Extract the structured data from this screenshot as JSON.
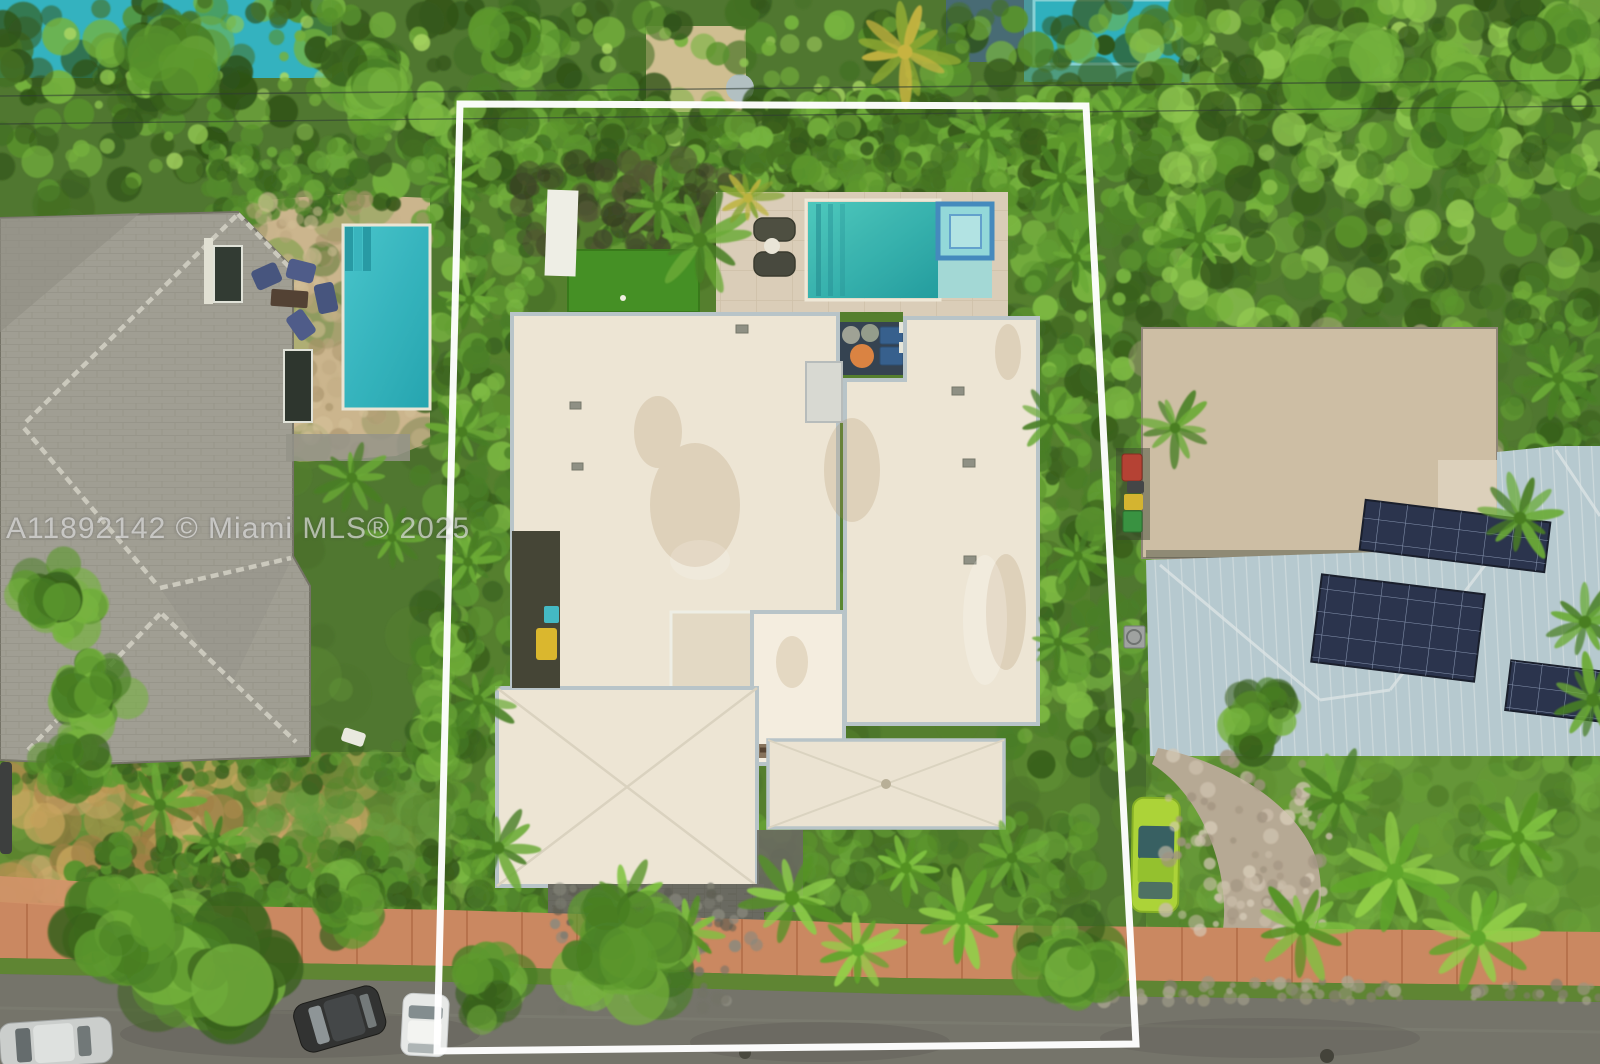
{
  "watermark": {
    "text": "A11892142 © Miami MLS® 2025",
    "color": "#eaeaea"
  },
  "palette": {
    "veg_base": "#47722c",
    "gray_roof": "#9b9b94",
    "ridge": "#c9c9c0",
    "roof": "#ece6d9",
    "parapet": "#b5c3cc",
    "deck": "#d8cdbb",
    "turf": "#3c8d20",
    "rug": "#2b3c4e",
    "pouf": "#d97f3f",
    "tanroof": "#cbbda6",
    "metal": "#b3c9d3",
    "solar": "#202c4a",
    "street": "#6e6f69",
    "sidewalk": "#c8845f",
    "paver": "#63655f",
    "lime": "#a8d334",
    "pool_center": "#2ab5b5",
    "pool_left": "#2fb9c6",
    "outline": "#ffffff"
  },
  "scene": {
    "mottle": [
      {
        "layer": "a",
        "x": 0,
        "y": 200,
        "w": 1600,
        "h": 864,
        "n": 420,
        "rmin": 10,
        "rmax": 30,
        "colors": [
          "#3f6a24",
          "#4e8029",
          "#5f9634",
          "#365c1e"
        ],
        "omin": 0.2,
        "omax": 0.5,
        "seed": 11
      },
      {
        "layer": "a",
        "x": 0,
        "y": 0,
        "w": 1600,
        "h": 205,
        "n": 520,
        "rmin": 7,
        "rmax": 20,
        "colors": [
          "#2c5317",
          "#3a6b1e",
          "#4f8f28",
          "#6fb13a",
          "#244b12"
        ],
        "omin": 0.5,
        "omax": 0.95,
        "seed": 12
      },
      {
        "layer": "a",
        "x": 60,
        "y": 20,
        "w": 1500,
        "h": 150,
        "n": 140,
        "rmin": 4,
        "rmax": 10,
        "colors": [
          "#8cc84e",
          "#a4d65f",
          "#6fae38"
        ],
        "omin": 0.5,
        "omax": 0.9,
        "seed": 13
      },
      {
        "layer": "a",
        "x": 420,
        "y": 90,
        "w": 115,
        "h": 930,
        "n": 330,
        "rmin": 6,
        "rmax": 18,
        "colors": [
          "#2f5a19",
          "#417a22",
          "#58992e",
          "#76b83f"
        ],
        "omin": 0.5,
        "omax": 0.95,
        "seed": 14
      },
      {
        "layer": "a",
        "x": 1005,
        "y": 95,
        "w": 155,
        "h": 670,
        "n": 300,
        "rmin": 6,
        "rmax": 18,
        "colors": [
          "#2f5a19",
          "#417a22",
          "#58992e",
          "#76b83f"
        ],
        "omin": 0.5,
        "omax": 0.95,
        "seed": 15
      },
      {
        "layer": "a",
        "x": 1140,
        "y": 0,
        "w": 460,
        "h": 335,
        "n": 400,
        "rmin": 7,
        "rmax": 20,
        "colors": [
          "#2c5317",
          "#3d701f",
          "#549428",
          "#72b23a",
          "#8cc84e"
        ],
        "omin": 0.5,
        "omax": 0.9,
        "seed": 16
      },
      {
        "layer": "a",
        "x": 1488,
        "y": 300,
        "w": 112,
        "h": 470,
        "n": 180,
        "rmin": 6,
        "rmax": 16,
        "colors": [
          "#2f5a19",
          "#447c24",
          "#5da031"
        ],
        "omin": 0.5,
        "omax": 0.9,
        "seed": 17
      },
      {
        "layer": "a",
        "x": 0,
        "y": 545,
        "w": 135,
        "h": 240,
        "n": 120,
        "rmin": 6,
        "rmax": 16,
        "colors": [
          "#31601a",
          "#447c24",
          "#5da031"
        ],
        "omin": 0.45,
        "omax": 0.85,
        "seed": 18
      },
      {
        "layer": "a",
        "x": 205,
        "y": 145,
        "w": 155,
        "h": 75,
        "n": 90,
        "rmin": 5,
        "rmax": 12,
        "colors": [
          "#31601a",
          "#4a8526",
          "#65a836"
        ],
        "omin": 0.5,
        "omax": 0.9,
        "seed": 19
      },
      {
        "layer": "a",
        "x": 458,
        "y": 100,
        "w": 630,
        "h": 105,
        "n": 430,
        "rmin": 6,
        "rmax": 16,
        "colors": [
          "#2c5317",
          "#3d701f",
          "#549428",
          "#6fb13a"
        ],
        "omin": 0.55,
        "omax": 0.95,
        "seed": 20
      },
      {
        "layer": "a",
        "x": 596,
        "y": 165,
        "w": 140,
        "h": 92,
        "n": 100,
        "rmin": 5,
        "rmax": 12,
        "colors": [
          "#2f5a19",
          "#4a8526",
          "#68a837"
        ],
        "omin": 0.5,
        "omax": 0.9,
        "seed": 21
      },
      {
        "layer": "a",
        "x": 520,
        "y": 160,
        "w": 220,
        "h": 90,
        "n": 90,
        "rmin": 6,
        "rmax": 14,
        "colors": [
          "#3a4526",
          "#2e3a1e",
          "#4a5230"
        ],
        "omin": 0.5,
        "omax": 0.85,
        "seed": 35
      },
      {
        "layer": "a",
        "x": 1150,
        "y": 700,
        "w": 450,
        "h": 240,
        "n": 240,
        "rmin": 8,
        "rmax": 22,
        "colors": [
          "#4e8029",
          "#5f9a31",
          "#3f7021",
          "#6fae3c"
        ],
        "omin": 0.3,
        "omax": 0.6,
        "seed": 22
      },
      {
        "layer": "a",
        "x": 0,
        "y": 755,
        "w": 450,
        "h": 150,
        "n": 170,
        "rmin": 8,
        "rmax": 20,
        "colors": [
          "#557f2e",
          "#6b9a3a",
          "#4b7427"
        ],
        "omin": 0.3,
        "omax": 0.6,
        "seed": 23
      },
      {
        "layer": "a",
        "x": 8,
        "y": 768,
        "w": 350,
        "h": 125,
        "n": 110,
        "rmin": 8,
        "rmax": 26,
        "colors": [
          "#b5914f",
          "#c7a55e",
          "#9b7a42",
          "#caa86b"
        ],
        "omin": 0.45,
        "omax": 0.8,
        "seed": 24
      },
      {
        "layer": "a",
        "x": 250,
        "y": 760,
        "w": 200,
        "h": 140,
        "n": 80,
        "rmin": 8,
        "rmax": 20,
        "colors": [
          "#4e8029",
          "#60993a"
        ],
        "omin": 0.4,
        "omax": 0.7,
        "seed": 25
      },
      {
        "layer": "a",
        "x": 75,
        "y": 843,
        "w": 375,
        "h": 68,
        "n": 190,
        "rmin": 6,
        "rmax": 14,
        "colors": [
          "#2c5317",
          "#3d701f",
          "#4f8f28"
        ],
        "omin": 0.55,
        "omax": 0.95,
        "seed": 26
      },
      {
        "layer": "a",
        "x": 0,
        "y": 745,
        "w": 440,
        "h": 42,
        "n": 120,
        "rmin": 5,
        "rmax": 11,
        "colors": [
          "#2f5a19",
          "#447c24",
          "#58992e"
        ],
        "omin": 0.5,
        "omax": 0.9,
        "seed": 27
      },
      {
        "layer": "a",
        "x": 458,
        "y": 818,
        "w": 640,
        "h": 100,
        "n": 230,
        "rmin": 7,
        "rmax": 16,
        "colors": [
          "#3f7021",
          "#549428",
          "#65a836",
          "#2f5a19"
        ],
        "omin": 0.4,
        "omax": 0.75,
        "seed": 28
      },
      {
        "layer": "a",
        "x": 248,
        "y": 198,
        "w": 180,
        "h": 255,
        "n": 140,
        "rmin": 4,
        "rmax": 11,
        "colors": [
          "#b9a47e",
          "#d2c09a",
          "#a5906a",
          "#c4b18b"
        ],
        "omin": 0.35,
        "omax": 0.65,
        "seed": 29
      },
      {
        "layer": "a",
        "x": 1146,
        "y": 332,
        "w": 347,
        "h": 222,
        "n": 150,
        "rmin": 6,
        "rmax": 20,
        "colors": [
          "#d7ccb8",
          "#bcae97",
          "#cdc0aa",
          "#b2a48c"
        ],
        "omin": 0.35,
        "omax": 0.65,
        "seed": 30
      },
      {
        "layer": "b",
        "x": 552,
        "y": 886,
        "w": 208,
        "h": 72,
        "n": 70,
        "rmin": 3,
        "rmax": 7,
        "colors": [
          "#75776f",
          "#54564f",
          "#83857d"
        ],
        "omin": 0.5,
        "omax": 0.85,
        "seed": 31
      },
      {
        "layer": "b",
        "x": 560,
        "y": 966,
        "w": 170,
        "h": 44,
        "n": 50,
        "rmin": 3,
        "rmax": 7,
        "colors": [
          "#8a8c84",
          "#6b6d65"
        ],
        "omin": 0.5,
        "omax": 0.8,
        "seed": 32
      },
      {
        "layer": "b",
        "x": 1165,
        "y": 752,
        "w": 165,
        "h": 180,
        "n": 90,
        "rmin": 3,
        "rmax": 8,
        "colors": [
          "#c7bcab",
          "#9c9080",
          "#d3c9b9"
        ],
        "omin": 0.5,
        "omax": 0.85,
        "seed": 33
      },
      {
        "layer": "b",
        "x": 1090,
        "y": 980,
        "w": 510,
        "h": 22,
        "n": 70,
        "rmin": 3,
        "rmax": 7,
        "colors": [
          "#96937f",
          "#7e7b6c",
          "#a7a492"
        ],
        "omin": 0.5,
        "omax": 0.8,
        "seed": 34
      }
    ],
    "palms": [
      {
        "x": 700,
        "y": 240,
        "r": 46,
        "seed": 101
      },
      {
        "x": 658,
        "y": 206,
        "r": 34,
        "seed": 102
      },
      {
        "x": 748,
        "y": 198,
        "r": 30,
        "seed": 103,
        "c": [
          "#b9b23a",
          "#7da02c"
        ]
      },
      {
        "x": 905,
        "y": 52,
        "r": 46,
        "seed": 104,
        "c": [
          "#c4b23e",
          "#86a42e"
        ]
      },
      {
        "x": 985,
        "y": 135,
        "r": 32,
        "seed": 105
      },
      {
        "x": 1118,
        "y": 115,
        "r": 36,
        "seed": 106
      },
      {
        "x": 452,
        "y": 182,
        "r": 28,
        "seed": 107
      },
      {
        "x": 470,
        "y": 300,
        "r": 30,
        "seed": 108
      },
      {
        "x": 462,
        "y": 432,
        "r": 34,
        "seed": 109
      },
      {
        "x": 468,
        "y": 562,
        "r": 30,
        "seed": 110
      },
      {
        "x": 478,
        "y": 700,
        "r": 34,
        "seed": 111
      },
      {
        "x": 498,
        "y": 848,
        "r": 40,
        "seed": 112
      },
      {
        "x": 1062,
        "y": 178,
        "r": 34,
        "seed": 113
      },
      {
        "x": 1076,
        "y": 258,
        "r": 30,
        "seed": 114
      },
      {
        "x": 1052,
        "y": 420,
        "r": 32,
        "seed": 115
      },
      {
        "x": 1078,
        "y": 556,
        "r": 30,
        "seed": 116
      },
      {
        "x": 1058,
        "y": 642,
        "r": 28,
        "seed": 117
      },
      {
        "x": 625,
        "y": 905,
        "r": 42,
        "seed": 118,
        "c": [
          "#4c8f1e",
          "#79c23c"
        ]
      },
      {
        "x": 688,
        "y": 932,
        "r": 34,
        "seed": 119,
        "c": [
          "#4c8f1e",
          "#79c23c"
        ]
      },
      {
        "x": 792,
        "y": 898,
        "r": 46,
        "seed": 120,
        "c": [
          "#4c8f1e",
          "#86cc45"
        ]
      },
      {
        "x": 858,
        "y": 950,
        "r": 40,
        "seed": 121,
        "c": [
          "#58a426",
          "#8ccf45"
        ]
      },
      {
        "x": 906,
        "y": 868,
        "r": 36,
        "seed": 122,
        "c": [
          "#4c8f1e",
          "#79c23c"
        ]
      },
      {
        "x": 962,
        "y": 918,
        "r": 44,
        "seed": 123,
        "c": [
          "#58a426",
          "#8ccf45"
        ]
      },
      {
        "x": 1012,
        "y": 858,
        "r": 34,
        "seed": 124
      },
      {
        "x": 1395,
        "y": 872,
        "r": 54,
        "seed": 125,
        "c": [
          "#58a426",
          "#8ccf45"
        ]
      },
      {
        "x": 1302,
        "y": 928,
        "r": 46,
        "seed": 126,
        "c": [
          "#4c8f1e",
          "#79c23c"
        ]
      },
      {
        "x": 1478,
        "y": 938,
        "r": 50,
        "seed": 127,
        "c": [
          "#58a426",
          "#8ccf45"
        ]
      },
      {
        "x": 1338,
        "y": 798,
        "r": 42,
        "seed": 128
      },
      {
        "x": 1518,
        "y": 838,
        "r": 42,
        "seed": 129,
        "c": [
          "#4c8f1e",
          "#79c23c"
        ]
      },
      {
        "x": 160,
        "y": 805,
        "r": 38,
        "seed": 130
      },
      {
        "x": 214,
        "y": 843,
        "r": 30,
        "seed": 131
      },
      {
        "x": 352,
        "y": 478,
        "r": 34,
        "seed": 132
      },
      {
        "x": 392,
        "y": 538,
        "r": 28,
        "seed": 133
      },
      {
        "x": 1200,
        "y": 238,
        "r": 38,
        "seed": 134
      },
      {
        "x": 1520,
        "y": 518,
        "r": 40,
        "seed": 135
      },
      {
        "x": 1558,
        "y": 378,
        "r": 36,
        "seed": 136
      },
      {
        "x": 1175,
        "y": 428,
        "r": 34,
        "seed": 137
      },
      {
        "x": 1585,
        "y": 622,
        "r": 40,
        "seed": 138
      },
      {
        "x": 1593,
        "y": 700,
        "r": 42,
        "seed": 139
      }
    ],
    "canopies": [
      {
        "x": 210,
        "y": 958,
        "r": 85
      },
      {
        "x": 118,
        "y": 934,
        "r": 62
      },
      {
        "x": 625,
        "y": 952,
        "r": 68
      },
      {
        "x": 486,
        "y": 988,
        "r": 46
      },
      {
        "x": 1068,
        "y": 958,
        "r": 56
      },
      {
        "x": 58,
        "y": 598,
        "r": 50
      },
      {
        "x": 96,
        "y": 690,
        "r": 46
      },
      {
        "x": 372,
        "y": 88,
        "r": 52
      },
      {
        "x": 178,
        "y": 58,
        "r": 56
      },
      {
        "x": 520,
        "y": 38,
        "r": 46
      },
      {
        "x": 1342,
        "y": 66,
        "r": 60
      },
      {
        "x": 1462,
        "y": 118,
        "r": 55
      },
      {
        "x": 1560,
        "y": 58,
        "r": 50
      },
      {
        "x": 70,
        "y": 760,
        "r": 40
      },
      {
        "x": 340,
        "y": 905,
        "r": 44
      },
      {
        "x": 445,
        "y": 742,
        "r": 40
      },
      {
        "x": 448,
        "y": 640,
        "r": 36
      },
      {
        "x": 1262,
        "y": 720,
        "r": 44
      }
    ]
  }
}
